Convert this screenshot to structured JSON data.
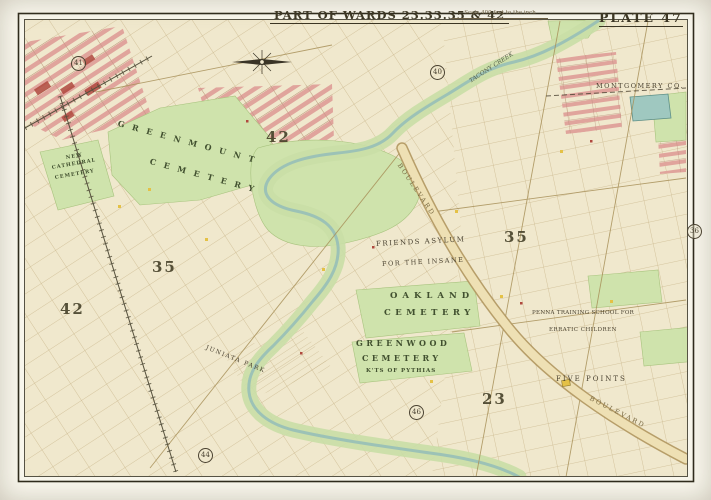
{
  "header": {
    "title": "PART OF WARDS 23.33.35 & 42",
    "scale_note": "Scale 400 feet to the inch",
    "plate": "PLATE 47"
  },
  "map": {
    "county_label": "MONTGOMERY CO.",
    "features": {
      "greenmount_1": "GREENMOUNT",
      "greenmount_2": "CEMETERY",
      "new_cathedral_1": "NEW",
      "new_cathedral_2": "CATHEDRAL",
      "new_cathedral_3": "CEMETERY",
      "friends_1": "FRIENDS ASYLUM",
      "friends_2": "FOR THE INSANE",
      "oakland_1": "OAKLAND",
      "oakland_2": "CEMETERY",
      "greenwood_1": "GREENWOOD",
      "greenwood_2": "CEMETERY",
      "greenwood_3": "K'TS OF PYTHIAS",
      "training_1": "PENNA TRAINING SCHOOL FOR",
      "training_2": "ERRATIC CHILDREN",
      "five_points": "FIVE POINTS",
      "boulevard_upper": "BOULEVARD",
      "boulevard_lower": "BOULEVARD",
      "creek": "TACONY CREEK",
      "juniata": "JUNIATA PARK"
    },
    "ward_numbers": {
      "w42_top": "42",
      "w35_left": "35",
      "w35_right": "35",
      "w42_left": "42",
      "w23": "23"
    },
    "plate_refs": {
      "r41": "41",
      "r40": "40",
      "r36": "36",
      "r46": "46",
      "r44": "44"
    }
  },
  "colors": {
    "paper": "#f0e8cd",
    "park_green": "#cfe3ac",
    "water": "#9cc2b6",
    "urban_pink": "#e0a49c",
    "boulevard_tan": "#eee0b4",
    "ink": "#4a4231"
  }
}
